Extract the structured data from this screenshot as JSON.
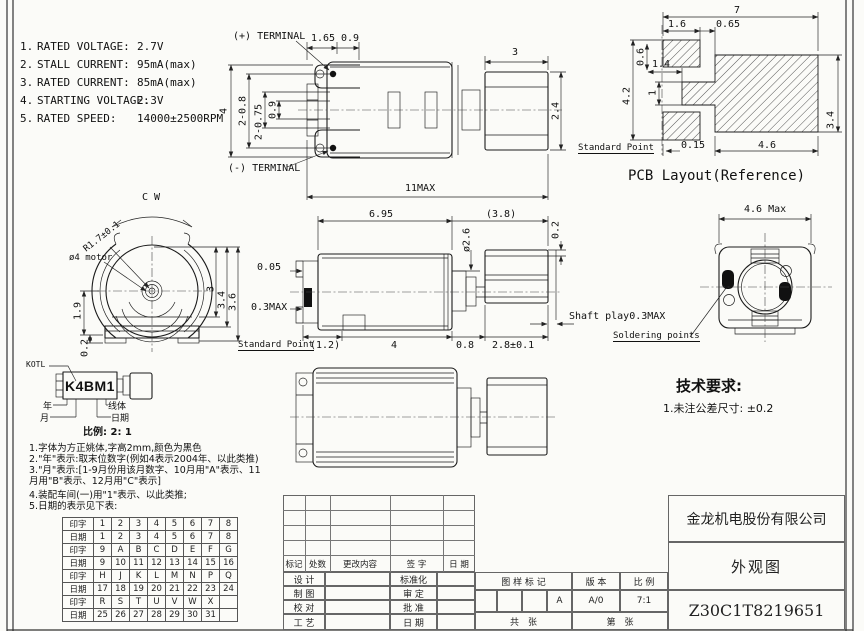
{
  "specs": [
    {
      "num": "1.",
      "label": "RATED VOLTAGE:",
      "value": "2.7V"
    },
    {
      "num": "2.",
      "label": "STALL CURRENT:",
      "value": "95mA(max)"
    },
    {
      "num": "3.",
      "label": "RATED CURRENT:",
      "value": "85mA(max)"
    },
    {
      "num": "4.",
      "label": "STARTING VOLTAGE:",
      "value": "2.3V"
    },
    {
      "num": "5.",
      "label": "RATED SPEED:",
      "value": "14000±2500RPM"
    }
  ],
  "top_view": {
    "terminal_plus": "(+) TERMINAL",
    "terminal_minus": "(-) TERMINAL",
    "d165": "1.65",
    "d09a": "0.9",
    "d3": "3",
    "d4": "4",
    "d2_08": "2-0.8",
    "d2_075": "2-0.75",
    "d09b": "0.9",
    "d24": "2.4",
    "d11max": "11MAX"
  },
  "pcb": {
    "d7": "7",
    "d16": "1.6",
    "d065": "0.65",
    "d14": "1.4",
    "d06": "0.6",
    "d42": "4.2",
    "d1": "1",
    "d34": "3.4",
    "d46": "4.6",
    "d015": "0.15",
    "standard_point": "Standard Point",
    "title": "PCB Layout(Reference)"
  },
  "front_view": {
    "cw": "C W",
    "r17": "R1.7±0.1",
    "motor": "ø4 motor",
    "d19": "1.9",
    "d02": "0.2",
    "d3": "3",
    "d34": "3.4",
    "d36": "3.6",
    "standard_point": "Standard Point"
  },
  "side_view": {
    "d695": "6.95",
    "d38": "(3.8)",
    "d26": "ø2.6",
    "d02": "0.2",
    "d005": "0.05",
    "d03max": "0.3MAX",
    "d12": "(1.2)",
    "d4": "4",
    "d08": "0.8",
    "d28": "2.8±0.1",
    "shaft_play": "Shaft play0.3MAX",
    "soldering": "Soldering points"
  },
  "rear_view": {
    "d46max": "4.6 Max"
  },
  "marking": {
    "logo": "KOTL",
    "code": "K4BM1",
    "year": "年",
    "month": "月",
    "line": "线体",
    "date": "日期",
    "scale": "比例: 2: 1"
  },
  "tech": {
    "title": "技术要求:",
    "item1": "1.未注公差尺寸: ±0.2"
  },
  "notes": [
    "1.字体为方正姚体,字高2mm,颜色为黑色",
    "2.\"年\"表示:取末位数字(例如4表示2004年、以此类推)",
    "3.\"月\"表示:[1-9月份用该月数字、10月用\"A\"表示、11",
    "月用\"B\"表示、12月用\"C\"表示]",
    "4.装配车间(一)用\"1\"表示、以此类推;",
    "5.日期的表示见下表:"
  ],
  "date_table": {
    "rows": [
      [
        "印字",
        "1",
        "2",
        "3",
        "4",
        "5",
        "6",
        "7",
        "8"
      ],
      [
        "日期",
        "1",
        "2",
        "3",
        "4",
        "5",
        "6",
        "7",
        "8"
      ],
      [
        "印字",
        "9",
        "A",
        "B",
        "C",
        "D",
        "E",
        "F",
        "G"
      ],
      [
        "日期",
        "9",
        "10",
        "11",
        "12",
        "13",
        "14",
        "15",
        "16"
      ],
      [
        "印字",
        "H",
        "J",
        "K",
        "L",
        "M",
        "N",
        "P",
        "Q"
      ],
      [
        "日期",
        "17",
        "18",
        "19",
        "20",
        "21",
        "22",
        "23",
        "24"
      ],
      [
        "印字",
        "R",
        "S",
        "T",
        "U",
        "V",
        "W",
        "X",
        ""
      ],
      [
        "日期",
        "25",
        "26",
        "27",
        "28",
        "29",
        "30",
        "31",
        ""
      ]
    ]
  },
  "tb": {
    "rev": [
      "标记",
      "处数",
      "更改内容",
      "签 字",
      "日 期"
    ],
    "sig_l": [
      "设 计",
      "制 图",
      "校 对",
      "工 艺"
    ],
    "sig_m": [
      "标准化",
      "审 定",
      "批 准",
      "日 期"
    ],
    "stamp": "图 样 标 记",
    "stamp_v": "A",
    "ver": "版 本",
    "ver_v": "A/0",
    "scale": "比 例",
    "scale_v": "7:1",
    "total": "共　张",
    "no": "第　张",
    "company": "金龙机电股份有限公司",
    "title": "外观图",
    "number": "Z30C1T8219651"
  }
}
